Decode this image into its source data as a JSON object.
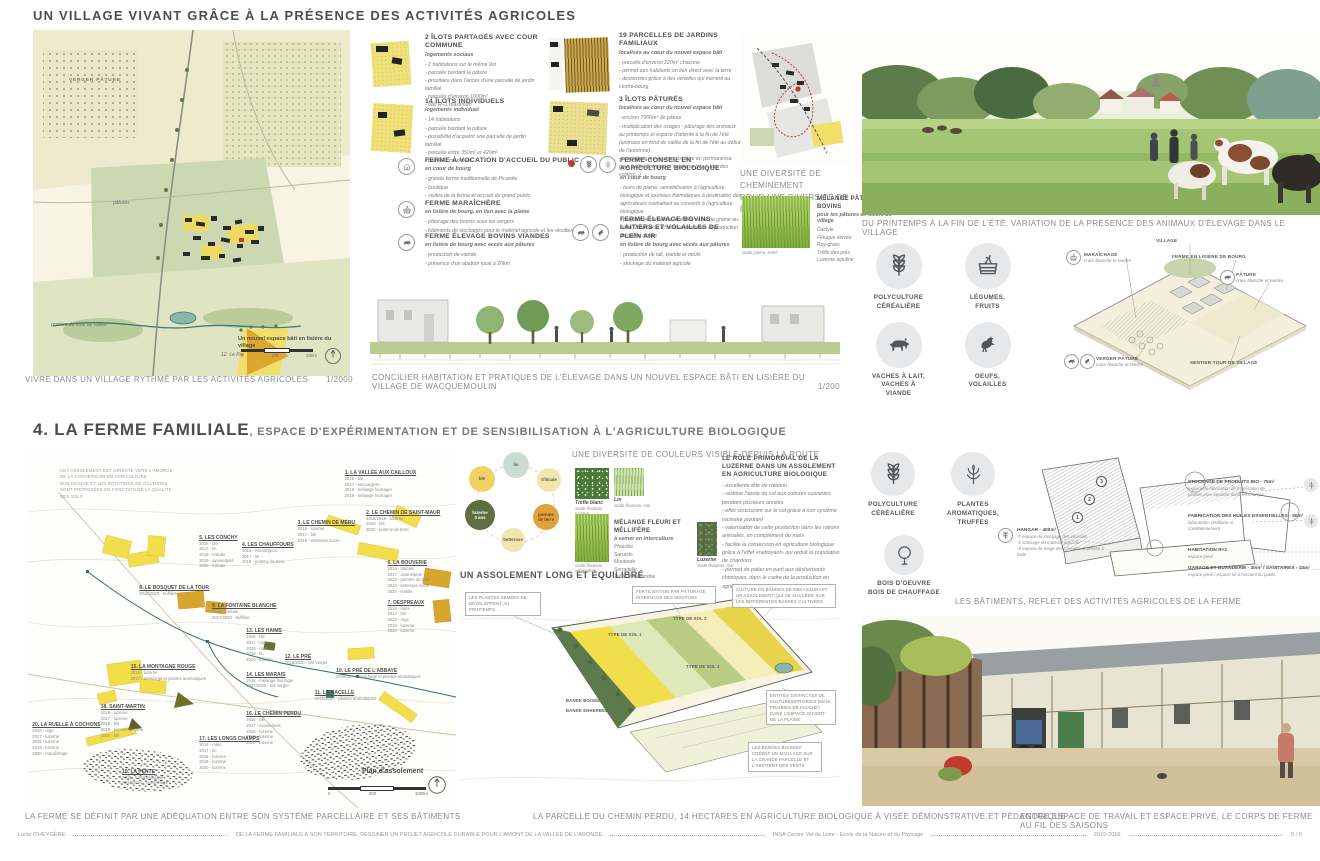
{
  "palette": {
    "yellow": "#f2de4a",
    "ochre": "#d9a62d",
    "olive": "#6b6f2a",
    "teal": "#3e7d74",
    "red": "#c0392b",
    "green": "#8fb573",
    "icon_bg": "#e7e8e9",
    "text": "#58585a",
    "caption": "#8a8b8d"
  },
  "s1": {
    "title": "UN VILLAGE VIVANT GRÂCE À LA PRÉSENCE DES ACTIVITÉS AGRICOLES",
    "map": {
      "labels": [
        {
          "t": "VERGER PÂTURE",
          "x": "36px",
          "y": "48px",
          "cls": "caps"
        },
        {
          "t": "pâtures",
          "x": "80px",
          "y": "170px",
          "cls": "ital"
        },
        {
          "t": "prairies de fond de vallée",
          "x": "18px",
          "y": "292px",
          "cls": "ital"
        },
        {
          "t": "12. Le Pré",
          "x": "188px",
          "y": "322px",
          "cls": "ital"
        }
      ],
      "new_area": "Un nouvel espace bâti en lisière du village",
      "scale_ticks": [
        "0",
        "100",
        "200m"
      ],
      "caption": "VIVRE DANS UN VILLAGE RYTHMÉ PAR LES ACTIVITÉS AGRICOLES",
      "scale": "1/2000"
    },
    "ilots": [
      {
        "head": "2 ÎLOTS PARTAGÉS AVEC COUR COMMUNE",
        "sub": "logements sociaux",
        "bullets": [
          "- 2 habitations sur le même îlot",
          "- parcelle bordant la pâture",
          "- prioritaire dans l'accès d'une parcelle de jardin familial",
          "- parcelle d'environ 1000m²",
          "- bâti R+1 maximum"
        ]
      },
      {
        "head": "14 ÎLOTS INDIVIDUELS",
        "sub": "logements individuel",
        "bullets": [
          "- 14 habitations",
          "- parcelle bordant la pâture",
          "- possibilité d'acquérir une parcelle de jardin familial",
          "- parcelle entre 350m² et 420m²",
          "- bâti R+1 maximum"
        ]
      },
      {
        "head": "19 PARCELLES DE JARDINS FAMILIAUX",
        "sub": "localisés au cœur du nouvel espace bâti",
        "bullets": [
          "- parcelle d'environ 220m² chacune",
          "- permet aux habitants un lien direct avec la terre",
          "- desservies grâce à des venelles qui mènent au centre-bourg"
        ]
      },
      {
        "head": "3 ÎLOTS PÂTURÉS",
        "sub": "localisés au cœur du nouvel espace bâti",
        "bullets": [
          "- environ 7000m² de pâture",
          "- multiplication des usages : pâturage des animaux au printemps et espace d'attente à la fin de l'été (animaux en fond de vallée de la fin de l'été au début de l'automne)",
          "- une pâture sur les trois est libre en permanence pour l'utilisation par les habitants (jeux, fête des voisins...)"
        ]
      }
    ],
    "fermes": [
      {
        "head": "FERME À VOCATION D'ACCUEIL DU PUBLIC",
        "sub": "en cœur de bourg",
        "bullets": [
          "- grande ferme traditionnelle de Picardie",
          "- boutique",
          "- visites de la ferme et accueil du grand public"
        ]
      },
      {
        "head": "FERME MARAÎCHÈRE",
        "sub": "en lisière de bourg, en lien avec la plaine",
        "bullets": [
          "- pâturage des bovins sous les vergers",
          "- bâtiments de stockages pour le matériel agricole et les récoltes"
        ]
      },
      {
        "head": "FERME ÉLEVAGE BOVINS VIANDES",
        "sub": "en lisière de bourg avec accès aux pâtures",
        "bullets": [
          "- production de viande",
          "- présence d'un abattoir local à 20km"
        ]
      },
      {
        "head": "FERME-CONSEIL EN AGRICULTURE BIOLOGIQUE",
        "sub": "en cœur de bourg",
        "bullets": [
          "- tours de plaine, sensibilisation à l'agriculture biologique et journées thématiques à destination des agriculteurs souhaitant se convertir à l'agriculture biologique",
          "- polyculture céréalière, huilerie, vente de graine au détail, fabrication d'huiles essentielles et production de truffes noires"
        ]
      },
      {
        "head": "FERME ÉLEVAGE BOVINS LAITIERS ET VOLAILLES DE PLEIN AIR",
        "sub": "en lisière de bourg avec accès aux pâtures",
        "bullets": [
          "- production de lait, viande et oeufs",
          "- stockage du matériel agricole"
        ]
      }
    ],
    "section_caption": "CONCILIER HABITATION ET PRATIQUES DE L'ÉLEVAGE DANS UN NOUVEL ESPACE BÂTI EN LISIÈRE DU VILLAGE DE WACQUEMOULIN",
    "section_scale": "1/200",
    "chem_heading": "UNE DIVERSITÉ DE CHEMINEMENT\nPOUR UNE DIVERSITÉ DE PRATIQUE",
    "melange": {
      "head": "MÉLANGE PÂTURAGE BOVINS",
      "sub": "pour les pâtures en lisière de village",
      "species": [
        "Dactyle",
        "Fétuque élevée",
        "Ray-grass",
        "Trèfle des prés",
        "Luzerne lupuline"
      ],
      "photo_caption": "stade prairie, semé"
    },
    "illu_caption": "DU PRINTEMPS À LA FIN DE L'ÉTÉ, VARIATION DE LA PRÉSENCE DES ANIMAUX D'ÉLEVAGE DANS LE VILLAGE",
    "icons": [
      {
        "icon": "wheat",
        "label": "POLYCULTURE\nCÉRÉALIÈRE"
      },
      {
        "icon": "crate",
        "label": "LÉGUMES,\nFRUITS"
      },
      {
        "icon": "cow",
        "label": "VACHES À LAIT,\nVACHES À VIANDE"
      },
      {
        "icon": "hen",
        "label": "OEUFS,\nVOLAILLES"
      }
    ],
    "axo": {
      "labels": [
        {
          "title": "MARAÎCHAGE",
          "sub": "craie blanche et tendre",
          "x": "44px",
          "y": "14px",
          "w": "70px"
        },
        {
          "title": "VILLAGE",
          "sub": "",
          "x": "116px",
          "y": "0px",
          "w": "60px"
        },
        {
          "title": "FERME EN LISIÈRE DE BOURG",
          "sub": "",
          "x": "132px",
          "y": "16px",
          "w": "90px"
        },
        {
          "title": "PÂTURE",
          "sub": "craie blanche et tendre",
          "x": "196px",
          "y": "34px",
          "w": "70px"
        },
        {
          "title": "VERGER PÂTURÉ",
          "sub": "craie blanche et tendre",
          "x": "56px",
          "y": "118px",
          "w": "70px"
        },
        {
          "title": "SENTIER TOUR DE VILLAGE",
          "sub": "",
          "x": "150px",
          "y": "122px",
          "w": "90px"
        }
      ]
    }
  },
  "s4": {
    "title": "4. LA FERME FAMILIALE",
    "subtitle": ", ESPACE D'EXPÉRIMENTATION ET DE SENSIBILISATION À L'AGRICULTURE BIOLOGIQUE",
    "map_note": "CET ASSOLEMENT EST ORIENTÉ VERS L'AMORCE DE LA CONVERSION EN AGRICULTURE BIOLOGIQUE ET LES ROTATIONS DE CULTURES SONT PROPOSÉES EN FONCTION DE LA QUALITÉ DES SOLS",
    "parcels": [
      {
        "name": "1. LA VALLÉE AUX CAILLOUX",
        "rot": "2016 - blé\n2017 - escourgeon\n2018 - mélange fourrager\n2019 - mélange fourrager",
        "x": "74%",
        "y": "5%"
      },
      {
        "name": "2. LE CHEMIN DE SAINT-MAUR",
        "rot": "2016/2018 - luzerne\n2019 - blé\n2020 - pomme de terre",
        "x": "79%",
        "y": "16%"
      },
      {
        "name": "3. LE CHEMIN DE MÉRU",
        "rot": "2016 - luzerne\n2017 - blé\n2018 - betterave sucre",
        "x": "63%",
        "y": "19%"
      },
      {
        "name": "4. LES CHAUFFOURS",
        "rot": "2016 - escourgeon\n2017 - lin\n2018 - pomme de terre",
        "x": "50%",
        "y": "25%"
      },
      {
        "name": "5. LES CONCHY",
        "rot": "2016 - blé\n2017 - lin\n2018 - triticale\n2019 - avoine/pois\n2020 - triticale",
        "x": "40%",
        "y": "23%"
      },
      {
        "name": "6. LA BOUVERIE",
        "rot": "2016 - triticale\n2017 - avoine/pois\n2018 - pomme de terre\n2019 - betterave sucre\n2020 - lentille",
        "x": "84%",
        "y": "30%"
      },
      {
        "name": "7. DESPREAUX",
        "rot": "2016 - maïs\n2017 - blé\n2018 - orge\n2019 - luzerne\n2020 - luzerne",
        "x": "84%",
        "y": "41%"
      },
      {
        "name": "8. LE BOSQUET DE LA TOUR",
        "rot": "2016/2020 - truffière",
        "x": "26%",
        "y": "37%"
      },
      {
        "name": "9. LA FONTAINE BLANCHE",
        "rot": "2016 - triticale\n2017/2020 - truffière",
        "x": "43%",
        "y": "42%"
      },
      {
        "name": "10. LE PRÉ DE L'ABBAYE",
        "rot": "2016/20 - maraîchage et plantes aromatiques",
        "x": "72%",
        "y": "60%"
      },
      {
        "name": "11. LA NACELLE",
        "rot": "2016/2020 - plantes aromatiques",
        "x": "67%",
        "y": "66%"
      },
      {
        "name": "12. LE PRÉ",
        "rot": "2016/2020 - pré verger",
        "x": "60%",
        "y": "56%"
      },
      {
        "name": "13. LES HAIMS",
        "rot": "2016 - blé\n2017 - orge\n2018 - maïs\n2019 - lin\n2020 - triticale",
        "x": "51%",
        "y": "49%"
      },
      {
        "name": "14. LES MARAIS",
        "rot": "2016 - mélange fourrager\n2017/2020 - pré verger",
        "x": "51%",
        "y": "61%"
      },
      {
        "name": "15. LA MONTAGNE ROUGE",
        "rot": "2016 - luzerne\n2017 - maïs/orge et plantes aromatiques",
        "x": "24%",
        "y": "59%"
      },
      {
        "name": "16. LE CHEMIN PERDU",
        "rot": "2016 - blé\n2017 - avoine/pois\n2018 - luzerne\n2019 - luzerne\n2020 - luzerne",
        "x": "51%",
        "y": "72%"
      },
      {
        "name": "17. LES LONGS CHAMPS",
        "rot": "2016 - maïs\n2017 - lin\n2018 - luzerne\n2019 - luzerne\n2020 - luzerne",
        "x": "40%",
        "y": "79%"
      },
      {
        "name": "18. SAINT-MARTIN",
        "rot": "2016 - luzerne\n2017 - luzerne\n2018 - blé\n2019 - pomme de terre\n2020 - blé",
        "x": "17%",
        "y": "70%"
      },
      {
        "name": "19. LA PENTE",
        "rot": "2016 - luzerne/dactyle\n2017/2020 - maraîchage",
        "x": "22%",
        "y": "88%"
      },
      {
        "name": "20. LA RUELLE À COCHONS",
        "rot": "2016 - orge\n2017 - luzerne\n2018 - luzerne\n2019 - luzerne\n2020 - maraîchage",
        "x": "1%",
        "y": "75%"
      }
    ],
    "plan_label": "Plan d'assolement",
    "plan_ticks": [
      "0",
      "500",
      "1000m"
    ],
    "map_caption": "LA FERME SE DÉFINIT PAR UNE ADÉQUATION ENTRE SON SYSTÈME PARCELLAIRE ET SES BÂTIMENTS",
    "rotation": {
      "heading": "UN ASSOLEMENT LONG ET ÉQUILIBRÉ",
      "nodes": [
        {
          "label": "lin",
          "color": "#c9ddd3",
          "x": "40px",
          "y": "0px",
          "s": "26px"
        },
        {
          "label": "triticale",
          "color": "#f2e5ae",
          "x": "74px",
          "y": "16px",
          "s": "24px"
        },
        {
          "label": "pomme\nde terre",
          "color": "#e2a23b",
          "tc": "#5b4a1f",
          "x": "70px",
          "y": "52px",
          "s": "26px"
        },
        {
          "label": "betterave",
          "color": "#f2e5ae",
          "x": "38px",
          "y": "76px",
          "s": "24px"
        },
        {
          "label": "luzerne\n3 ans",
          "color": "#5d6e3f",
          "tc": "#ffffff",
          "x": "2px",
          "y": "48px",
          "s": "30px"
        },
        {
          "label": "blé",
          "color": "#f0d264",
          "x": "6px",
          "y": "14px",
          "s": "26px"
        }
      ]
    },
    "colors_heading": "UNE DIVERSITÉ DE COULEURS VISIBLE DEPUIS LA ROUTE",
    "photos": [
      {
        "name": "Trèfle blanc",
        "caption": "stade floraison,\noctobre"
      },
      {
        "name": "Lin",
        "caption": "stade floraison, mai"
      },
      {
        "name": "Luzerne",
        "caption": "stade floraison, mai"
      }
    ],
    "fleuri": {
      "head": "MÉLANGE FLEURI ET MÉLLIFÈRE",
      "sub": "à semer en interculture",
      "species": [
        "Phacélie",
        "Sarrasin",
        "Moutarde",
        "Serradelle",
        "Trèfle d'Alexandrie"
      ]
    },
    "luzerne": {
      "head": "LE RÔLE PRIMORDIAL DE LA LUZERNE DANS UN ASSOLEMENT EN AGRICULTURE BIOLOGIQUE",
      "bullets": [
        "- excellente tête de rotation",
        "- restitue l'azote du sol aux cultures suivantes pendant plusieurs années",
        "- effet structurant sur le sol grâce à son système racinaire pivotant",
        "- valorisation de cette production dans les rations animales, en complément du maïs",
        "- facilite la conversion en agriculture biologique grâce à l'effet «nettoyant» qui réduit la population de chardons",
        "- permet de palier en parti aux désherbants chimiques, dans le cadre de la production en agriculture biologique"
      ]
    },
    "annotations": [
      {
        "text": "LES PLANTES SEMÉES SE DÉVELOPPENT AU PRINTEMPS",
        "x": "5px",
        "y": "12px",
        "w": "68px",
        "cls": "boxed"
      },
      {
        "text": "FERTILISATION PAR PÂTURAGE HIVERNAGE DES MOUTONS",
        "x": "172px",
        "y": "6px",
        "w": "76px",
        "cls": "boxed"
      },
      {
        "text": "CULTURE EN BANDES DE 50M ASSURANT UN ASSOLEMENT QUI SE SUCCÈDE SUR LES DIFFÉRENTES BANDES CULTIVÉES",
        "x": "272px",
        "y": "4px",
        "w": "96px",
        "cls": "boxed"
      },
      {
        "text": "TYPE DE SOL 1",
        "x": "148px",
        "y": "52px",
        "w": "40px",
        "cls": "strong"
      },
      {
        "text": "TYPE DE SOL 2",
        "x": "213px",
        "y": "36px",
        "w": "40px",
        "cls": "strong"
      },
      {
        "text": "TYPE DE SOL 3",
        "x": "226px",
        "y": "84px",
        "w": "40px",
        "cls": "strong"
      },
      {
        "text": "BANDE BOISÉE",
        "x": "106px",
        "y": "118px",
        "w": "44px",
        "cls": "strong"
      },
      {
        "text": "BANDE ENHERBÉE",
        "x": "106px",
        "y": "128px",
        "w": "50px",
        "cls": "strong"
      },
      {
        "text": "ENTITÉS DISTINCTES DE CULTURES/PRAIRIES (MAÏS, PRAIRIES DE FAUCHE) DANS L'ESPACE OUVERT DE LA PLAINE",
        "x": "306px",
        "y": "110px",
        "w": "62px",
        "cls": "boxed"
      },
      {
        "text": "LES BANDES BOISÉES CRÉENT UN MAILLAGE SUR LA GRANDE PARCELLE ET L'ABRITENT DES VENTS",
        "x": "288px",
        "y": "162px",
        "w": "66px",
        "cls": "boxed"
      }
    ],
    "persp_caption": "LA PARCELLE DU CHEMIN PERDU, 14 HECTARES EN AGRICULTURE BIOLOGIQUE À VISÉE DÉMONSTRATIVE ET PÉDAGOGIQUE",
    "farm_icons": [
      {
        "icon": "wheat",
        "label": "POLYCULTURE\nCÉRÉALIÈRE"
      },
      {
        "icon": "plant",
        "label": "PLANTES\nAROMATIQUES,\nTRUFFES"
      },
      {
        "icon": "tree",
        "label": "BOIS D'OEUVRE\nBOIS DE CHAUFFAGE"
      }
    ],
    "hangar": {
      "title": "HANGAR - 400m²",
      "items": "① espace de stockage des céréales\n② stockage du matériel agricole\n③ espace de triage des céréales et presse à huile"
    },
    "bldg_nums": [
      {
        "n": "1",
        "x": "82px",
        "y": "60px"
      },
      {
        "n": "2",
        "x": "94px",
        "y": "42px"
      },
      {
        "n": "3",
        "x": "106px",
        "y": "24px"
      }
    ],
    "bldg_labels": [
      {
        "title": "STOCKAGE DE PRODUITS BIO - 75m²",
        "sub": "espace de fabrication de macération de\nplantes pour épandre dans les champs",
        "x": "198px",
        "y": "28px",
        "w": "118px"
      },
      {
        "title": "FABRICATION DES HUILES ESSENTIELLES - 50m²",
        "sub": "laboratoire, distillerie et\nconditionnement",
        "x": "198px",
        "y": "62px",
        "w": "118px"
      },
      {
        "title": "HABITATION R+1",
        "sub": "espace privé",
        "x": "198px",
        "y": "96px",
        "w": "118px"
      },
      {
        "title": "GARAGE ET BUANDERIE - 30m² / SANITAIRES - 10m²",
        "sub": "espace privé / espace lié à l'accueil du public",
        "x": "198px",
        "y": "114px",
        "w": "130px"
      }
    ],
    "bldg_caption": "LES BÂTIMENTS, REFLET DES ACTIVITÉS AGRICOLES DE LA FERME",
    "court_caption": "ENTRE ESPACE DE TRAVAIL ET ESPACE PRIVÉ, LE CORPS DE FERME AU FIL DES SAISONS"
  },
  "footer": {
    "author": "Lucie D'HEYGÈRE",
    "project": "DE LA FERME FAMILIALE À SON TERRITOIRE, DESSINER UN PROJET AGRICOLE DURABLE POUR L'AMONT DE LA VALLÉE DE L'ARONDE",
    "school": "INSA Centre Val de Loire - École de la Nature et du Paysage",
    "year": "2015-2016",
    "page": "5 / 5"
  }
}
